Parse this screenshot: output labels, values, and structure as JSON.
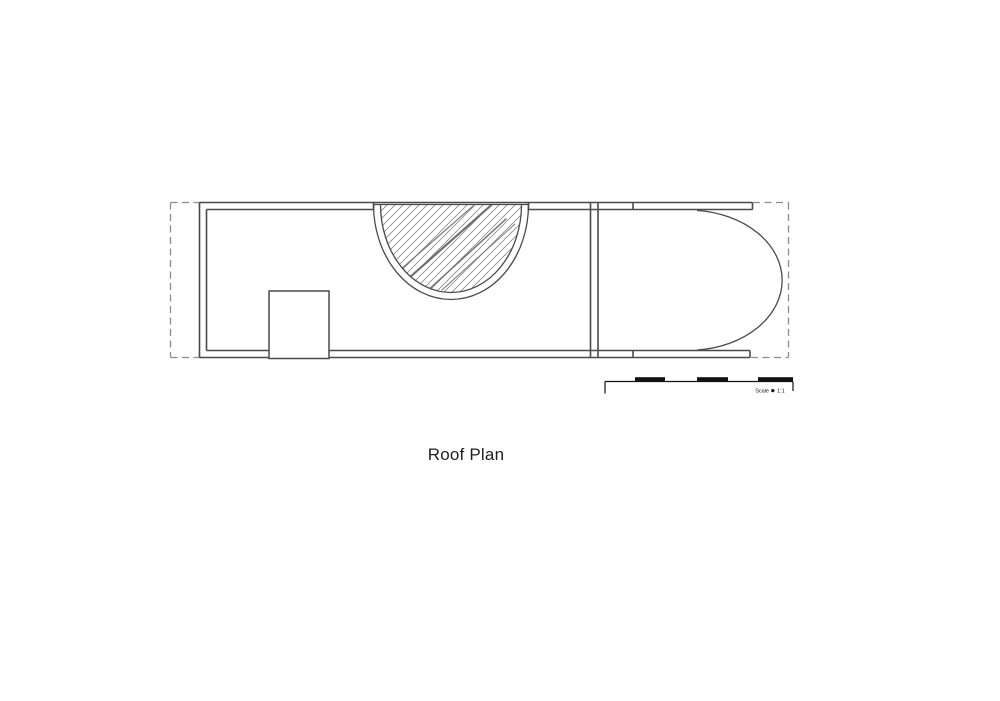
{
  "drawing": {
    "title": "Roof Plan",
    "scale_bar": {
      "label": "Scale",
      "separator_icon": "dot-icon",
      "ratio": "1:1"
    },
    "colors": {
      "background": "#ffffff",
      "wall_line": "#4a4a4a",
      "dashed_boundary": "#8c8c8c",
      "hatch_line": "#8f8f8f",
      "scale_bar_black": "#121212",
      "title_text": "#1f1f1f"
    }
  }
}
